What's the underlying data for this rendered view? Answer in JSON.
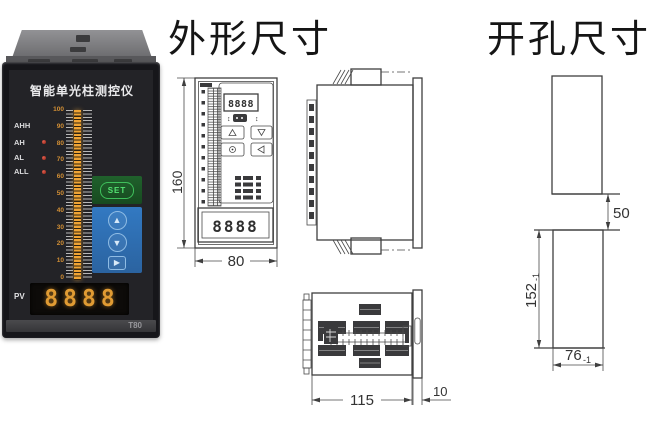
{
  "titles": {
    "outline": "外形尺寸",
    "cutout": "开孔尺寸"
  },
  "device": {
    "title": "智能单光柱测控仪",
    "alarms": [
      "AHH",
      "AH",
      "AL",
      "ALL"
    ],
    "scale": [
      "100",
      "90",
      "80",
      "70",
      "60",
      "50",
      "40",
      "30",
      "20",
      "10",
      "0"
    ],
    "set": "SET",
    "keys": [
      "▲",
      "▼",
      "▶"
    ],
    "pv": "PV",
    "display": "8888",
    "model": "T80",
    "colors": {
      "bar": "#f0a435",
      "set_green": "#54e372",
      "keypad_blue": "#2e70b4",
      "digit_amber": "#e09b33",
      "led_red": "#b3322a"
    }
  },
  "front_view": {
    "display_top": "8888",
    "display_bottom": "8888",
    "dim_height": "160",
    "dim_width": "80"
  },
  "bottom_view": {
    "dim_depth": "115",
    "dim_bezel": "10"
  },
  "cutout_view": {
    "dim_gap": "50",
    "dim_height": "152",
    "dim_height_tol": "-1",
    "dim_width": "76",
    "dim_width_tol": "-1"
  }
}
